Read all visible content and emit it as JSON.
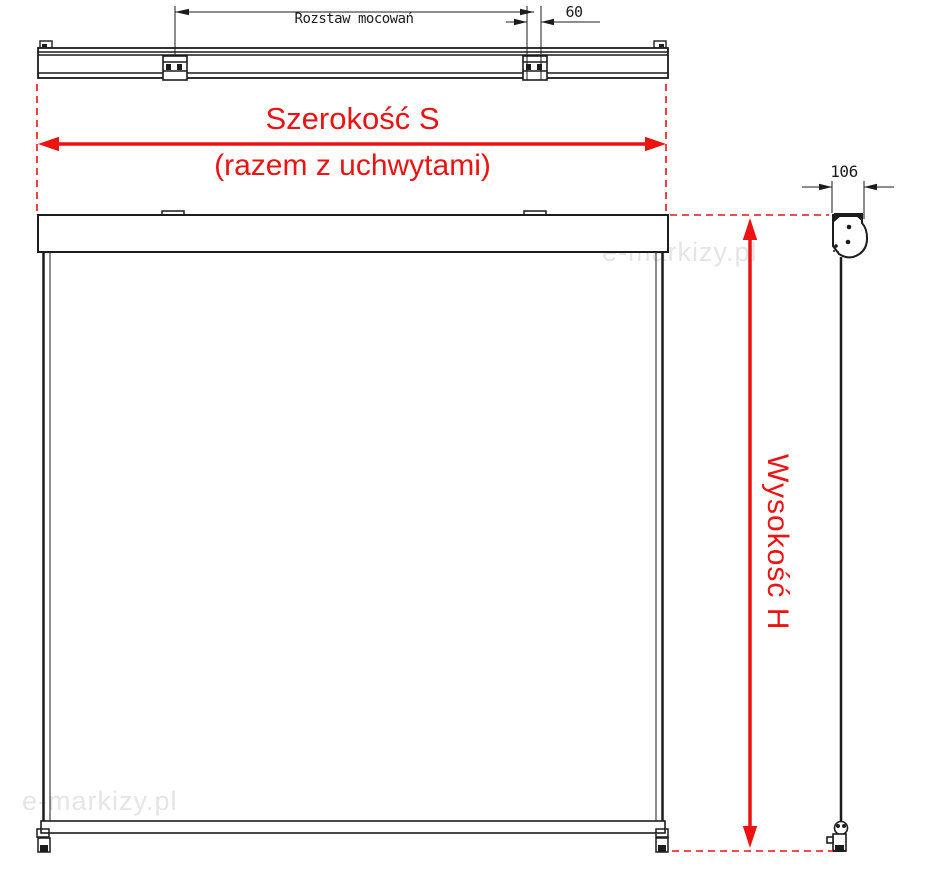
{
  "labels": {
    "mount_spacing": "Rozstaw mocowań",
    "bracket_width": "60",
    "width_title": "Szerokość S",
    "width_subtitle": "(razem z uchwytami)",
    "height_title": "Wysokość H",
    "cassette_depth": "106"
  },
  "watermarks": {
    "center": "e-markizy.pl",
    "bottom_left": "e-markizy.pl"
  },
  "colors": {
    "dimension_red": "#ec1313",
    "line_black": "#1c1c1c",
    "watermark_gray": "#e5e5e5"
  }
}
